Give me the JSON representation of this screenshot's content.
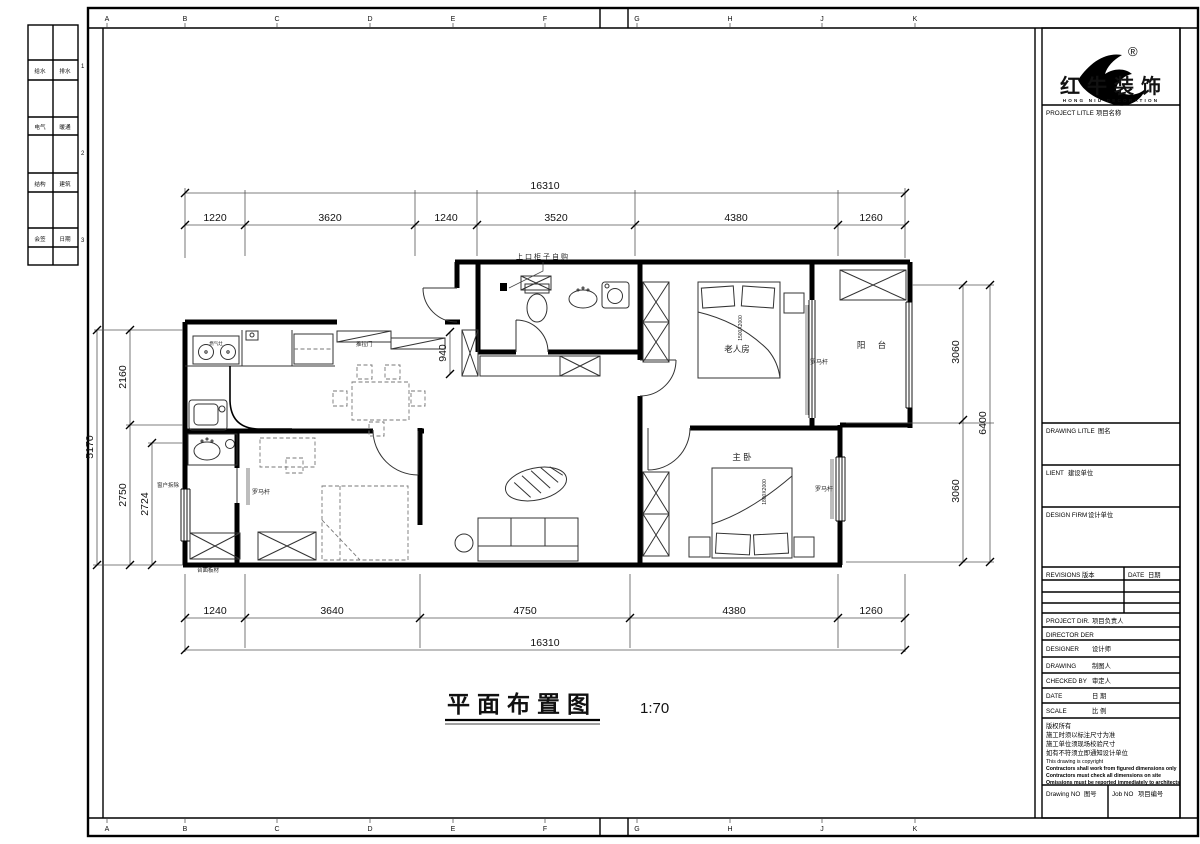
{
  "frame": {
    "letters": [
      "A",
      "B",
      "C",
      "D",
      "E",
      "F",
      "G",
      "H",
      "J",
      "K"
    ],
    "strip_rows": [
      [
        "给水",
        "排水"
      ],
      [
        "电气",
        "暖通"
      ],
      [
        "结构",
        "建筑"
      ],
      [
        "会签",
        "日期"
      ]
    ],
    "strip_numbers": [
      "1",
      "2",
      "3"
    ]
  },
  "title": {
    "text": "平面布置图",
    "scale": "1:70"
  },
  "brand": {
    "cn": "红牛装饰",
    "en": "HONG NIU DECORATION",
    "reg": "®"
  },
  "tb": {
    "project_label": "PROJECT LITLE",
    "project_cn": "项目名称",
    "drawing_title_label": "DRAWING LITLE",
    "drawing_title_cn": "图名",
    "client_label": "LIENT",
    "client_cn": "建设单位",
    "firm_label": "DESIGN FIRM",
    "firm_cn": "设计单位",
    "revisions_label": "REVISIONS",
    "revisions_cn": "版本",
    "rev_date_label": "DATE",
    "rev_date_cn": "日期",
    "pdir_label": "PROJECT DIR.",
    "pdir_cn": "项目负责人",
    "director_label": "DIRECTOR DER",
    "designer_label": "DESIGNER",
    "designer_cn": "设计师",
    "drawing_label": "DRAWING",
    "drawing_cn": "制图人",
    "checked_label": "CHECKED BY",
    "checked_cn": "审定人",
    "date_label": "DATE",
    "date_cn": "日  期",
    "scale_label": "SCALE",
    "scale_cn": "比  例",
    "notes": [
      "版权所有",
      "施工时须以标注尺寸为准",
      "施工单位须现场校验尺寸",
      "如有不符须立即通知设计单位",
      "This drawing is copyright",
      "Contractors shall work from figured dimensions only",
      "Contractors must check all dimensions on site",
      "Omissions must be reported immediately to architects"
    ],
    "dno_label": "Drawing NO",
    "dno_cn": "图号",
    "jno_label": "Job NO",
    "jno_cn": "项目编号"
  },
  "dims": {
    "top_overall": "16310",
    "top": [
      "1220",
      "3620",
      "1240",
      "3520",
      "4380",
      "1260"
    ],
    "bottom": [
      "1240",
      "3640",
      "4750",
      "4380",
      "1260"
    ],
    "bottom_overall": "16310",
    "left_overall": "5170",
    "left": [
      "2160",
      "2750",
      "2724"
    ],
    "right": [
      "3060",
      "3060"
    ],
    "right_overall": "6400",
    "hall": "940"
  },
  "rooms": {
    "elder": "老人房",
    "master": "主  卧",
    "balcony": "阳  台"
  },
  "notes": {
    "rod1": "罗马杆",
    "rod2": "罗马杆",
    "rod3": "罗马杆",
    "top_note": "上口柜子自购",
    "sliding": "推拉门",
    "window": "窗户拆除",
    "board": "台面板材",
    "stove": "燃气灶",
    "bed_master": "1800X2000",
    "bed_elder": "1500X2000"
  }
}
